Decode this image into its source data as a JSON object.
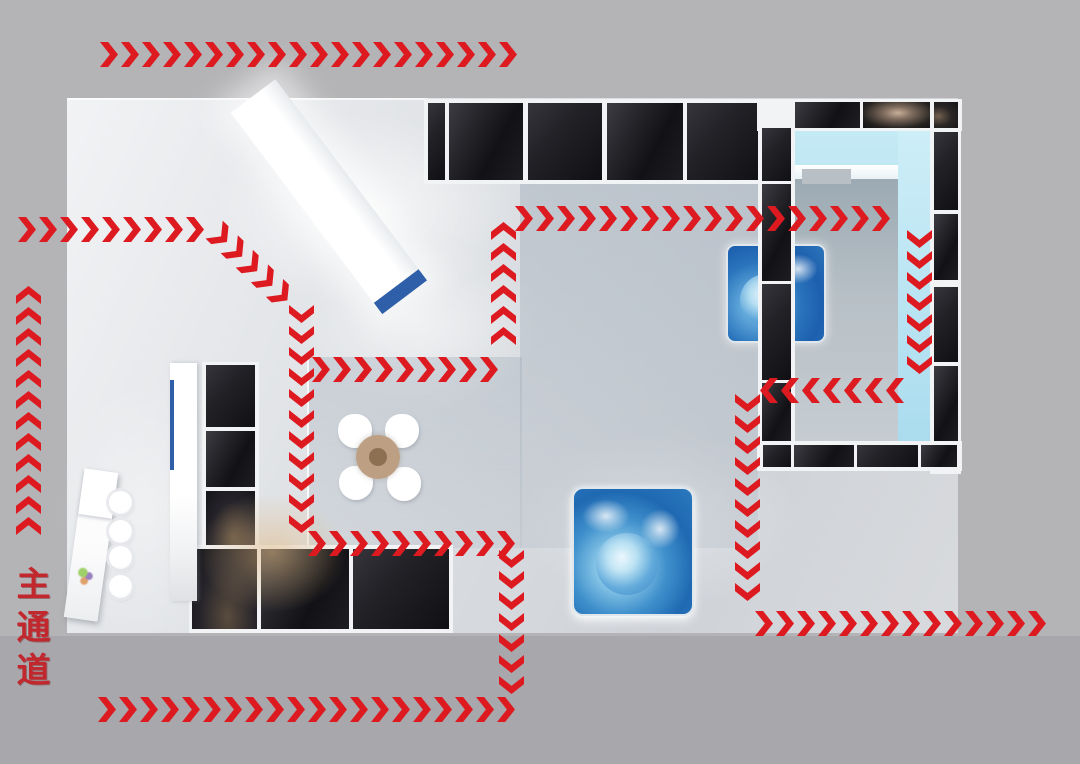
{
  "diagram": {
    "main_aisle_label": "主通道"
  },
  "colors": {
    "arrow_red": "#de1a21",
    "arrow_shadow": "#8c1014",
    "label_red": "#c2272d",
    "accent_blue": "#2e5fa8",
    "screen_blue": "#1b66b4",
    "glass_cyan": "#aadcec",
    "panel_dark": "#1b1b20",
    "floor_light": "#e3e5e8",
    "background": "#b4b3b6",
    "background_lower": "#a8a7ab",
    "table_tan": "#bda084"
  },
  "flow": {
    "top_row": {
      "name": "top-aisle-flow",
      "dir": "right",
      "count": 20
    },
    "entry_row": {
      "name": "left-entry-flow",
      "dir": "right",
      "count": 9
    },
    "entry_curve": {
      "name": "entry-curve-flow",
      "dir": "right",
      "count": 5
    },
    "mid_col": {
      "name": "center-down-flow",
      "dir": "down",
      "count": 11
    },
    "mid_row_upper": {
      "name": "center-right-flow",
      "dir": "right",
      "count": 9
    },
    "up_col": {
      "name": "center-up-flow",
      "dir": "up",
      "count": 6
    },
    "top_right_row": {
      "name": "upper-right-flow",
      "dir": "right",
      "count": 18
    },
    "right_col_outer": {
      "name": "room-right-down-flow",
      "dir": "down",
      "count": 7
    },
    "back_row": {
      "name": "room-return-flow",
      "dir": "left",
      "count": 7
    },
    "right_col_inner": {
      "name": "room-left-down-flow",
      "dir": "down",
      "count": 10
    },
    "exit_row": {
      "name": "right-exit-flow",
      "dir": "right",
      "count": 14
    },
    "mid_row_lower": {
      "name": "lower-center-flow",
      "dir": "right",
      "count": 10
    },
    "lower_col": {
      "name": "lower-down-flow",
      "dir": "down",
      "count": 7
    },
    "bottom_row": {
      "name": "bottom-aisle-flow",
      "dir": "right",
      "count": 20
    },
    "left_edge_col": {
      "name": "main-aisle-up-flow",
      "dir": "up",
      "count": 12
    }
  },
  "booth": {
    "stool_count": 4,
    "chair_count": 4,
    "screen_count": 2,
    "screens": [
      "wall-mounted-display",
      "floor-standing-display"
    ]
  }
}
